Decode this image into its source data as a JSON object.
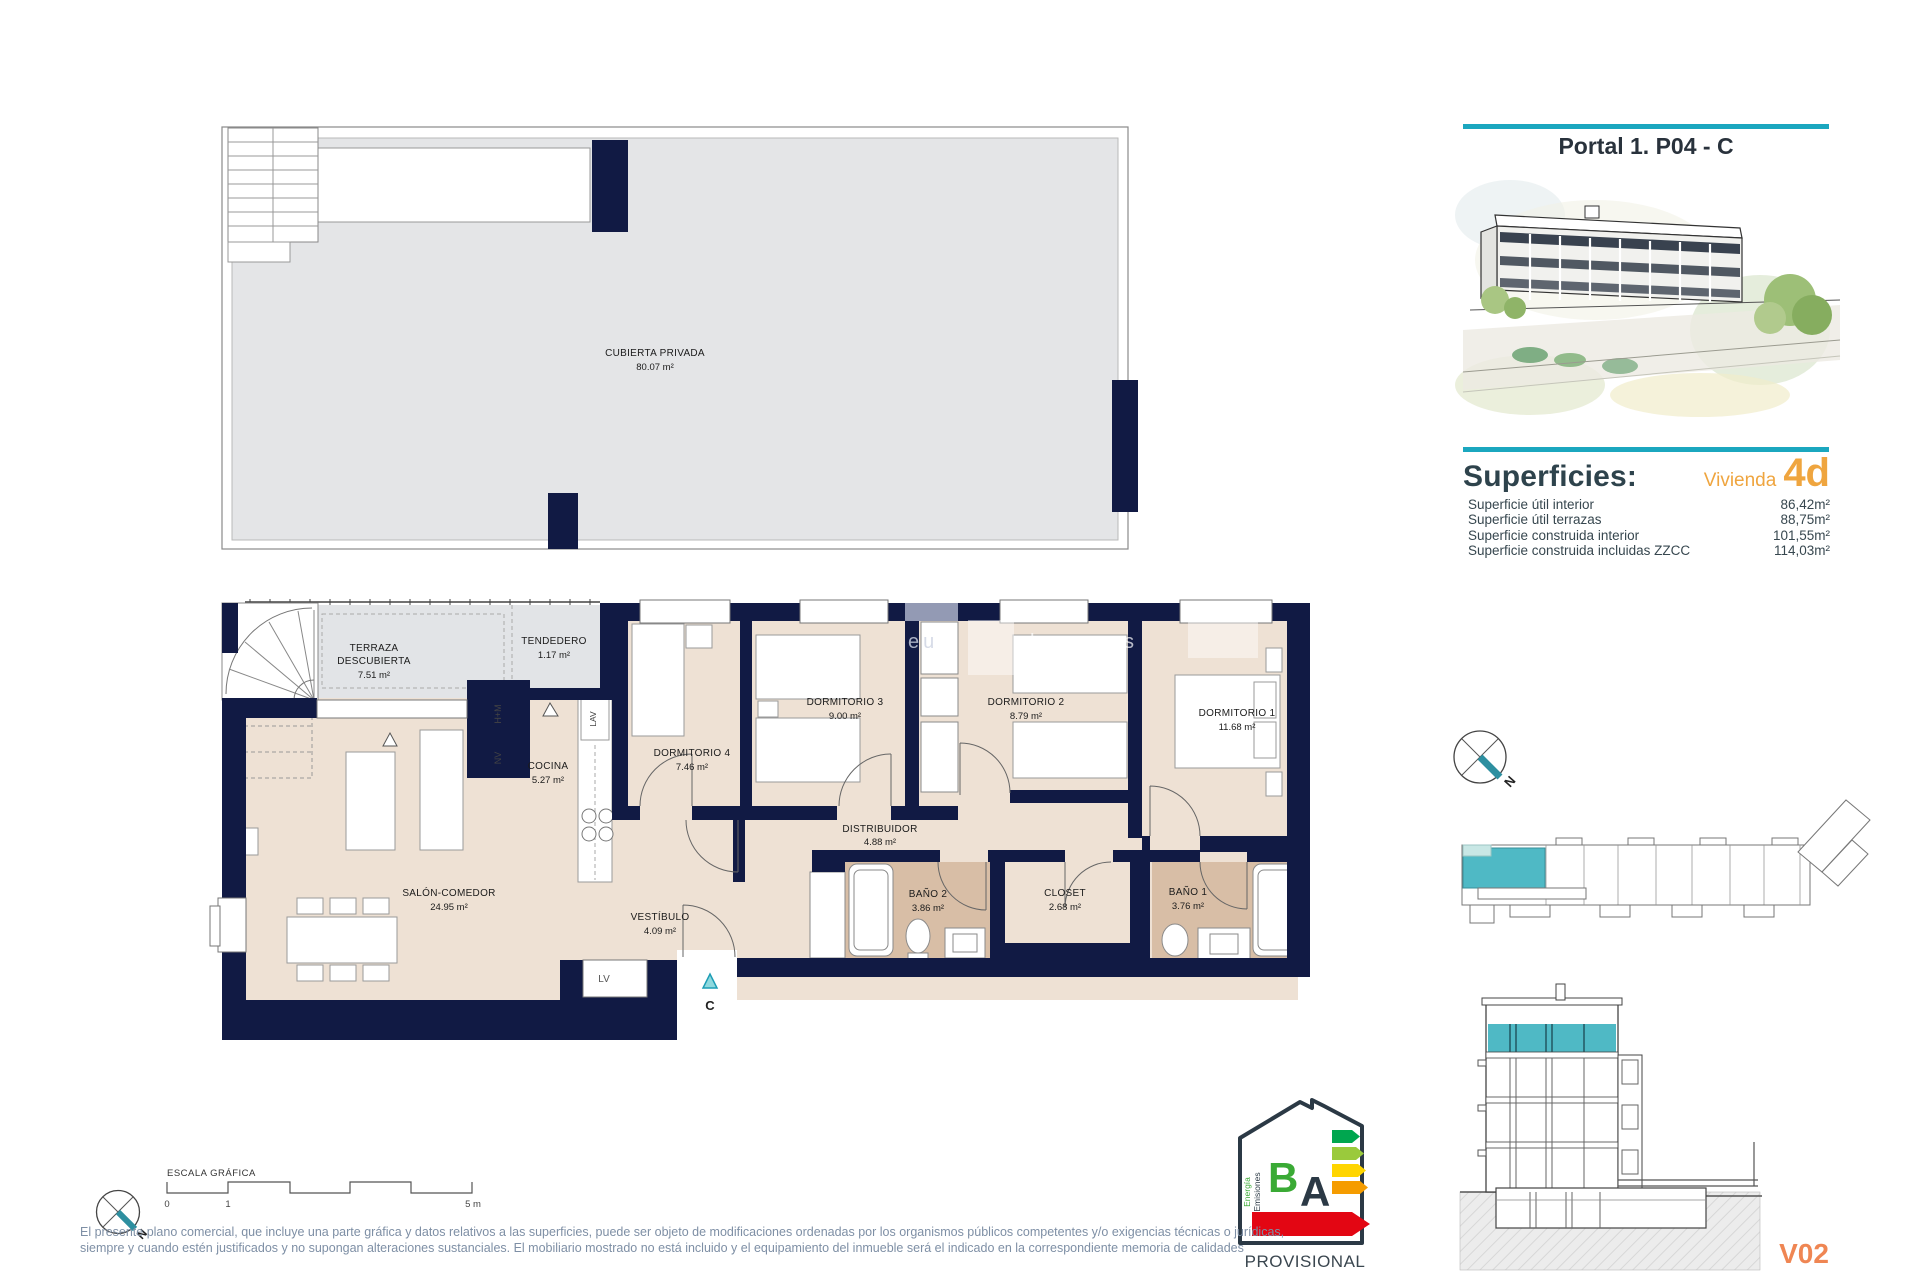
{
  "header": {
    "title": "Portal 1. P04 - C"
  },
  "superficies": {
    "heading": "Superficies:",
    "vivienda_label": "Vivienda",
    "vivienda_code": "4d",
    "rows": [
      {
        "label": "Superficie útil interior",
        "value": "86,42m²"
      },
      {
        "label": "Superficie útil terrazas",
        "value": "88,75m²"
      },
      {
        "label": "Superficie construida interior",
        "value": "101,55m²"
      },
      {
        "label": "Superficie construida incluidas ZZCC",
        "value": "114,03m²"
      }
    ]
  },
  "roof_plan": {
    "name": "CUBIERTA PRIVADA",
    "area": "80.07 m²"
  },
  "floor_plan": {
    "terraza": {
      "l1": "TERRAZA",
      "l2": "DESCUBIERTA",
      "area": "7.51 m²"
    },
    "tendedero": {
      "name": "TENDEDERO",
      "area": "1.17 m²"
    },
    "cocina": {
      "name": "COCINA",
      "area": "5.27 m²"
    },
    "salon": {
      "name": "SALÓN-COMEDOR",
      "area": "24.95 m²"
    },
    "vestibulo": {
      "name": "VESTÍBULO",
      "area": "4.09 m²"
    },
    "distribuidor": {
      "name": "DISTRIBUIDOR",
      "area": "4.88 m²"
    },
    "dormitorio1": {
      "name": "DORMITORIO 1",
      "area": "11.68 m²"
    },
    "dormitorio2": {
      "name": "DORMITORIO 2",
      "area": "8.79 m²"
    },
    "dormitorio3": {
      "name": "DORMITORIO 3",
      "area": "9.00 m²"
    },
    "dormitorio4": {
      "name": "DORMITORIO 4",
      "area": "7.46 m²"
    },
    "bano1": {
      "name": "BAÑO 1",
      "area": "3.76 m²"
    },
    "bano2": {
      "name": "BAÑO 2",
      "area": "3.86 m²"
    },
    "closet": {
      "name": "CLOSET",
      "area": "2.68 m²"
    },
    "appliances": {
      "hm": "H+M",
      "nv": "NV",
      "lav": "LAV",
      "lv": "LV"
    },
    "entry_marker": "C"
  },
  "compass": {
    "north": "N"
  },
  "scale_bar": {
    "title": "ESCALA GRÁFICA",
    "tick0": "0",
    "tick1": "1",
    "tick5": "5 m"
  },
  "energy_label": {
    "letter_b": "B",
    "letter_a": "A",
    "energia": "Energía",
    "emisiones": "Emisiones",
    "status": "PROVISIONAL"
  },
  "section": {
    "code": "V02"
  },
  "watermark": {
    "part1": "eu",
    "part2": "homes"
  },
  "disclaimer": {
    "line1": "El presente plano comercial, que incluye una parte gráfica y datos relativos a las superficies, puede ser objeto de modificaciones ordenadas por los organismos públicos competentes y/o exigencias técnicas o jurídicas,",
    "line2": "siempre y cuando estén justificados y no supongan alteraciones sustanciales. El mobiliario mostrado no está incluido y el equipamiento del inmueble será el indicado en la correspondiente memoria de calidades"
  },
  "colors": {
    "accent_teal": "#1ba7bf",
    "accent_orange": "#efa53f",
    "wall_navy": "#111a44",
    "version_orange": "#ef8653"
  }
}
